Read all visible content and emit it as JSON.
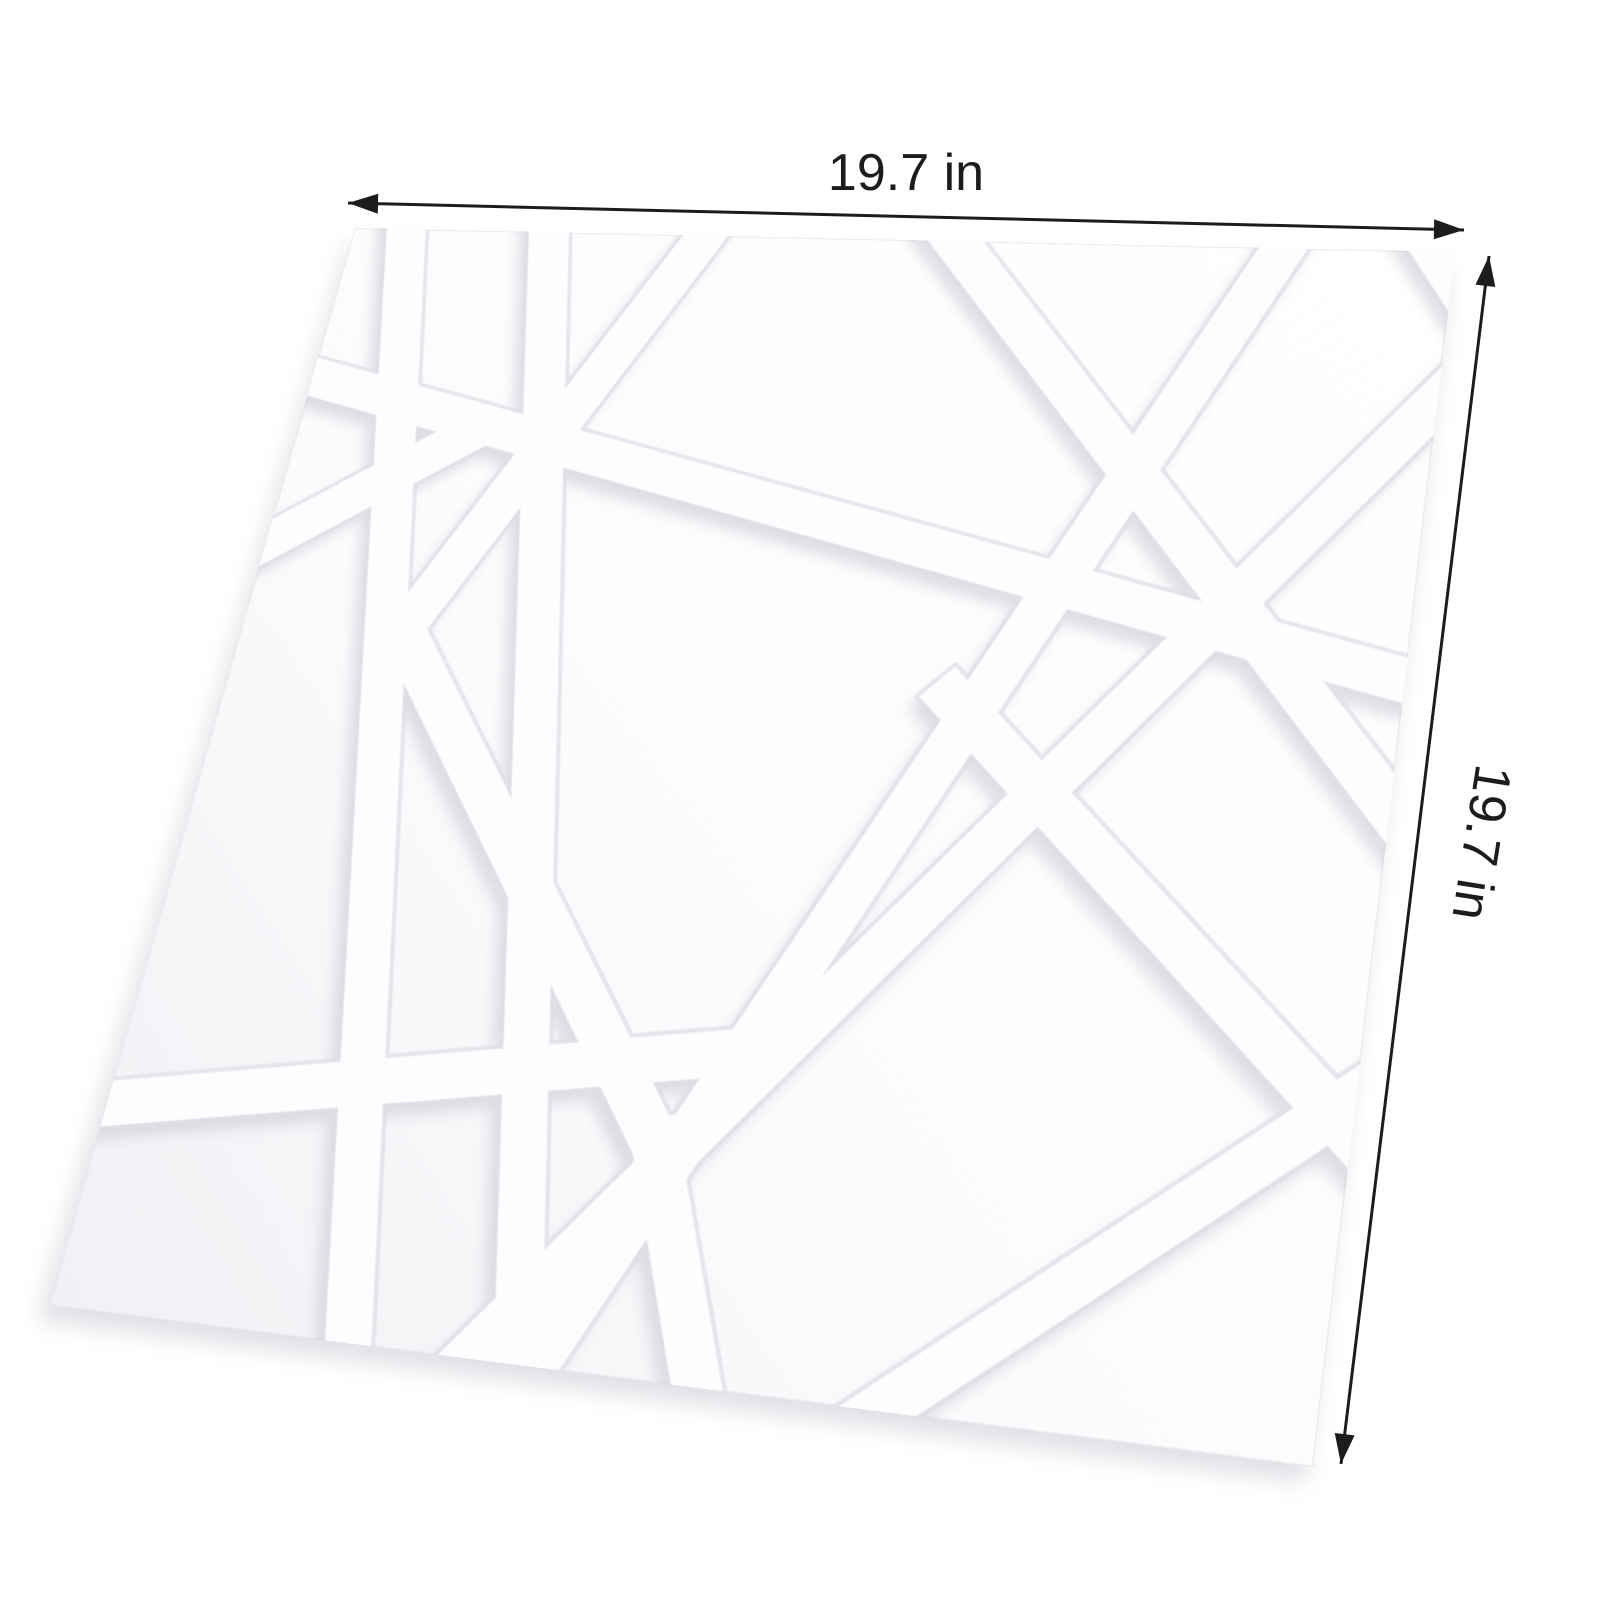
{
  "figure": {
    "kind": "product dimension diagram",
    "subject": "White 3D textured wall panel with raised geometric crossing-lines pattern, shown in perspective"
  },
  "dimensions": {
    "width_label": "19.7 in",
    "height_label": "19.7 in"
  },
  "colors": {
    "background": "#ffffff",
    "dimension_line": "#1c1c1c",
    "label_text": "#1c1c1c",
    "panel_face_light": "#ffffff",
    "panel_face_dark": "#f2f2f6",
    "panel_outline": "#ebebf0",
    "panel_shadow": "#c7c7d1",
    "strip_face": "#fdfdff",
    "strip_edge": "#dfdfe7",
    "strip_shadow": "#b9b9c6"
  }
}
